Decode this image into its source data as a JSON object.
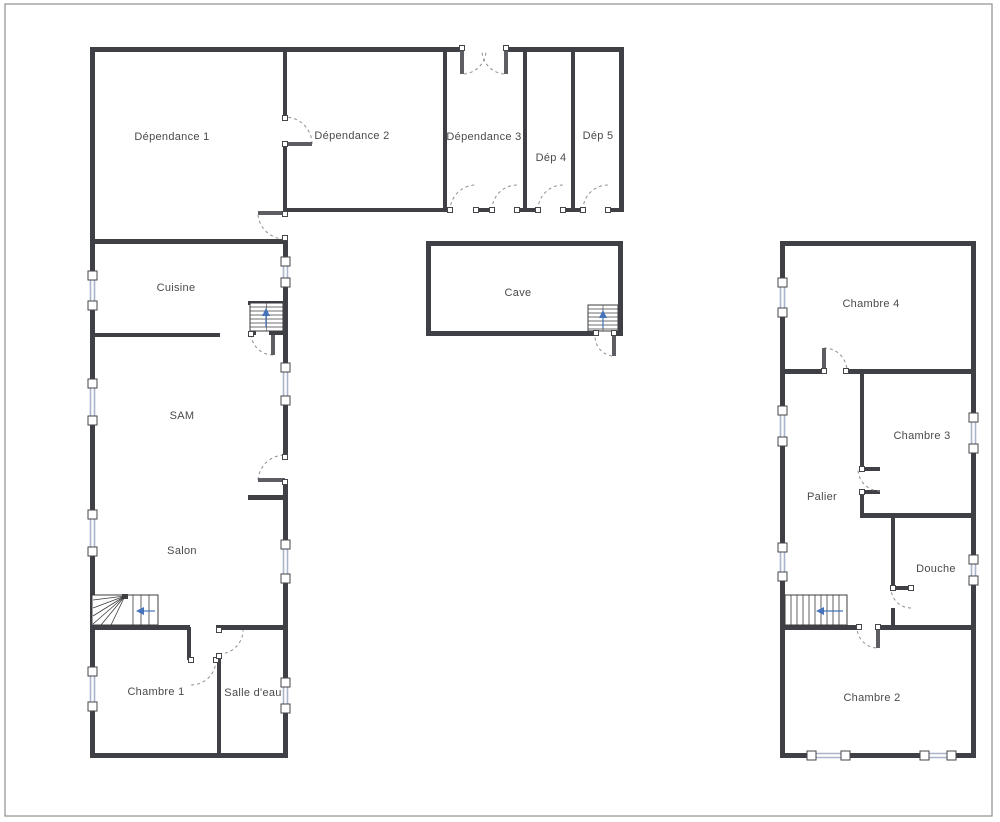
{
  "title": "Plan d'étage",
  "colors": {
    "background": "#ffffff",
    "page_border": "#8f8f8f",
    "wall": "#3f4045",
    "door_leaf": "#5d5e63",
    "door_arc": "#8f8f8f",
    "hinge_fill": "#ffffff",
    "hinge_stroke": "#45464a",
    "window_glass": "#a9b4cd",
    "window_frame": "#45464a",
    "stair_line": "#3c3c3f",
    "stair_arrow": "#4573b9",
    "label": "#4a4a4a"
  },
  "canvas": {
    "width": 1000,
    "height": 822,
    "page_border": [
      5,
      4,
      987,
      812
    ]
  },
  "rooms": [
    {
      "id": "dependance-1",
      "label": "Dépendance 1",
      "x": 172,
      "y": 137
    },
    {
      "id": "dependance-2",
      "label": "Dépendance 2",
      "x": 352,
      "y": 136
    },
    {
      "id": "dependance-3",
      "label": "Dépendance 3",
      "x": 484,
      "y": 137
    },
    {
      "id": "dep-4",
      "label": "Dép 4",
      "x": 551,
      "y": 158
    },
    {
      "id": "dep-5",
      "label": "Dép 5",
      "x": 598,
      "y": 136
    },
    {
      "id": "cuisine",
      "label": "Cuisine",
      "x": 176,
      "y": 288
    },
    {
      "id": "cave",
      "label": "Cave",
      "x": 518,
      "y": 293
    },
    {
      "id": "sam",
      "label": "SAM",
      "x": 182,
      "y": 416
    },
    {
      "id": "salon",
      "label": "Salon",
      "x": 182,
      "y": 551
    },
    {
      "id": "chambre-1",
      "label": "Chambre 1",
      "x": 156,
      "y": 692
    },
    {
      "id": "salle-d-eau",
      "label": "Salle d'eau",
      "x": 253,
      "y": 693
    },
    {
      "id": "chambre-4",
      "label": "Chambre 4",
      "x": 871,
      "y": 304
    },
    {
      "id": "chambre-3",
      "label": "Chambre 3",
      "x": 922,
      "y": 436
    },
    {
      "id": "palier",
      "label": "Palier",
      "x": 822,
      "y": 497
    },
    {
      "id": "douche",
      "label": "Douche",
      "x": 936,
      "y": 569
    },
    {
      "id": "chambre-2",
      "label": "Chambre 2",
      "x": 872,
      "y": 698
    }
  ],
  "walls": [
    [
      90,
      47,
      370,
      5
    ],
    [
      508,
      47,
      116,
      5
    ],
    [
      90,
      47,
      5,
      224
    ],
    [
      90,
      310,
      5,
      69
    ],
    [
      90,
      425,
      5,
      85
    ],
    [
      90,
      556,
      5,
      111
    ],
    [
      90,
      711,
      5,
      47
    ],
    [
      90,
      753,
      198,
      5
    ],
    [
      283,
      47,
      4,
      71
    ],
    [
      283,
      144,
      4,
      70
    ],
    [
      90,
      239,
      198,
      5
    ],
    [
      283,
      244,
      5,
      13
    ],
    [
      283,
      287,
      5,
      76
    ],
    [
      283,
      405,
      5,
      52
    ],
    [
      283,
      482,
      5,
      58
    ],
    [
      283,
      583,
      5,
      95
    ],
    [
      283,
      713,
      5,
      45
    ],
    [
      90,
      333,
      130,
      4
    ],
    [
      248,
      495,
      37,
      5
    ],
    [
      443,
      47,
      4,
      165
    ],
    [
      523,
      47,
      4,
      165
    ],
    [
      571,
      47,
      4,
      165
    ],
    [
      619,
      47,
      5,
      165
    ],
    [
      285,
      208,
      165,
      4
    ],
    [
      476,
      208,
      16,
      4
    ],
    [
      517,
      208,
      21,
      4
    ],
    [
      563,
      208,
      20,
      4
    ],
    [
      608,
      208,
      16,
      4
    ],
    [
      90,
      625,
      100,
      5
    ],
    [
      216,
      625,
      67,
      5
    ],
    [
      187,
      627,
      4,
      33
    ],
    [
      217,
      656,
      4,
      99
    ],
    [
      426,
      241,
      197,
      5
    ],
    [
      426,
      241,
      5,
      95
    ],
    [
      618,
      241,
      5,
      95
    ],
    [
      426,
      331,
      170,
      5
    ],
    [
      614,
      331,
      9,
      5
    ],
    [
      248,
      301,
      37,
      4
    ],
    [
      248,
      331,
      8,
      4
    ],
    [
      269,
      331,
      14,
      4
    ],
    [
      780,
      241,
      196,
      5
    ],
    [
      780,
      241,
      5,
      37
    ],
    [
      780,
      317,
      5,
      89
    ],
    [
      780,
      446,
      5,
      97
    ],
    [
      780,
      581,
      5,
      177
    ],
    [
      971,
      241,
      5,
      172
    ],
    [
      971,
      453,
      5,
      102
    ],
    [
      971,
      585,
      5,
      173
    ],
    [
      780,
      753,
      27,
      5
    ],
    [
      850,
      753,
      70,
      5
    ],
    [
      956,
      753,
      20,
      5
    ],
    [
      780,
      369,
      44,
      5
    ],
    [
      846,
      369,
      130,
      5
    ],
    [
      860,
      369,
      4,
      100
    ],
    [
      860,
      492,
      4,
      25
    ],
    [
      860,
      467,
      20,
      4
    ],
    [
      860,
      490,
      20,
      4
    ],
    [
      860,
      513,
      116,
      5
    ],
    [
      891,
      513,
      4,
      77
    ],
    [
      891,
      586,
      20,
      4
    ],
    [
      891,
      608,
      4,
      19
    ],
    [
      780,
      625,
      79,
      5
    ],
    [
      878,
      625,
      98,
      5
    ]
  ],
  "doors": [
    {
      "name": "porte-dependance1-dependance2",
      "arc": [
        312,
        144,
        27,
        0,
        285,
        117
      ],
      "leaf": [
        285,
        142,
        27,
        4
      ],
      "dots": [
        [
          285,
          118
        ],
        [
          285,
          144
        ]
      ]
    },
    {
      "name": "porte-double-dependance3-gauche",
      "arc": [
        464,
        74,
        24,
        0,
        486,
        50
      ],
      "leaf": [
        460,
        50,
        4,
        24
      ],
      "dots": [
        [
          462,
          48
        ]
      ]
    },
    {
      "name": "porte-double-dependance3-droite",
      "arc": [
        504,
        74,
        24,
        1,
        482,
        50
      ],
      "leaf": [
        504,
        50,
        4,
        24
      ],
      "dots": [
        [
          506,
          48
        ]
      ]
    },
    {
      "name": "porte-dependance3-sud-1",
      "arc": [
        450,
        211,
        26,
        1,
        476,
        185
      ],
      "dots": [
        [
          450,
          210
        ],
        [
          476,
          210
        ]
      ]
    },
    {
      "name": "porte-dependance3-sud-2",
      "arc": [
        492,
        210,
        25,
        1,
        517,
        185
      ],
      "dots": [
        [
          492,
          210
        ],
        [
          517,
          210
        ]
      ]
    },
    {
      "name": "porte-dep4-sud",
      "arc": [
        538,
        210,
        25,
        1,
        563,
        185
      ],
      "dots": [
        [
          538,
          210
        ],
        [
          563,
          210
        ]
      ]
    },
    {
      "name": "porte-dep5-sud",
      "arc": [
        583,
        210,
        25,
        1,
        608,
        185
      ],
      "dots": [
        [
          583,
          210
        ],
        [
          608,
          210
        ]
      ]
    },
    {
      "name": "porte-couloir-dependance1",
      "arc": [
        258,
        215,
        27,
        0,
        283,
        239
      ],
      "leaf": [
        258,
        211,
        27,
        4
      ],
      "dots": [
        [
          285,
          214
        ],
        [
          285,
          238
        ]
      ]
    },
    {
      "name": "porte-escalier-cuisine",
      "arc": [
        273,
        355,
        22,
        1,
        251,
        333
      ],
      "leaf": [
        271,
        335,
        4,
        20
      ],
      "dots": [
        [
          251,
          334
        ]
      ]
    },
    {
      "name": "porte-sam-exterieur",
      "arc": [
        258,
        480,
        27,
        1,
        285,
        455
      ],
      "leaf": [
        258,
        478,
        27,
        4
      ],
      "dots": [
        [
          285,
          457
        ],
        [
          285,
          482
        ]
      ]
    },
    {
      "name": "porte-chambre-1",
      "arc": [
        216,
        660,
        25,
        1,
        191,
        685
      ],
      "dots": [
        [
          191,
          660
        ],
        [
          216,
          660
        ]
      ]
    },
    {
      "name": "porte-salle-d-eau",
      "arc": [
        219,
        654,
        24,
        0,
        243,
        630
      ],
      "dots": [
        [
          219,
          630
        ],
        [
          219,
          656
        ]
      ]
    },
    {
      "name": "porte-cave",
      "arc": [
        612,
        356,
        20,
        1,
        595,
        336
      ],
      "leaf": [
        612,
        336,
        4,
        20
      ],
      "dots": [
        [
          596,
          333
        ],
        [
          614,
          333
        ]
      ]
    },
    {
      "name": "porte-chambre-4",
      "arc": [
        824,
        348,
        23,
        1,
        847,
        371
      ],
      "leaf": [
        822,
        348,
        4,
        23
      ],
      "dots": [
        [
          824,
          371
        ],
        [
          846,
          371
        ]
      ]
    },
    {
      "name": "porte-chambre-3",
      "arc": [
        880,
        491,
        22,
        1,
        858,
        469
      ],
      "dots": [
        [
          862,
          469
        ],
        [
          862,
          492
        ]
      ]
    },
    {
      "name": "porte-douche",
      "arc": [
        911,
        608,
        20,
        1,
        891,
        588
      ],
      "dots": [
        [
          893,
          588
        ],
        [
          911,
          588
        ]
      ]
    },
    {
      "name": "porte-chambre-2",
      "arc": [
        876,
        648,
        21,
        1,
        857,
        627
      ],
      "leaf": [
        876,
        627,
        4,
        21
      ],
      "dots": [
        [
          859,
          627
        ],
        [
          878,
          627
        ]
      ]
    }
  ],
  "windows": [
    {
      "o": "v",
      "x": 92.5,
      "a": 271,
      "b": 310
    },
    {
      "o": "v",
      "x": 92.5,
      "a": 379,
      "b": 425
    },
    {
      "o": "v",
      "x": 92.5,
      "a": 510,
      "b": 556
    },
    {
      "o": "v",
      "x": 92.5,
      "a": 667,
      "b": 711
    },
    {
      "o": "v",
      "x": 285.5,
      "a": 257,
      "b": 287
    },
    {
      "o": "v",
      "x": 285.5,
      "a": 363,
      "b": 405
    },
    {
      "o": "v",
      "x": 285.5,
      "a": 540,
      "b": 583
    },
    {
      "o": "v",
      "x": 285.5,
      "a": 678,
      "b": 713
    },
    {
      "o": "v",
      "x": 782.5,
      "a": 278,
      "b": 317
    },
    {
      "o": "v",
      "x": 782.5,
      "a": 406,
      "b": 446
    },
    {
      "o": "v",
      "x": 782.5,
      "a": 543,
      "b": 581
    },
    {
      "o": "v",
      "x": 973.5,
      "a": 413,
      "b": 453
    },
    {
      "o": "v",
      "x": 973.5,
      "a": 555,
      "b": 585
    },
    {
      "o": "h",
      "y": 755.5,
      "a": 807,
      "b": 850
    },
    {
      "o": "h",
      "y": 755.5,
      "a": 920,
      "b": 956
    }
  ],
  "stairs": [
    {
      "name": "escalier-cuisine",
      "box": [
        250,
        303,
        33,
        28
      ],
      "treads_y": [
        307,
        311,
        315,
        319,
        323,
        327
      ],
      "centerline": true,
      "arrow": {
        "tip": [
          266,
          308
        ],
        "tail": [
          266,
          327
        ]
      }
    },
    {
      "name": "escalier-cave",
      "box": [
        588,
        305,
        30,
        26
      ],
      "treads_y": [
        309,
        313,
        317,
        321,
        325,
        329
      ],
      "centerline": true,
      "arrow": {
        "tip": [
          603,
          310
        ],
        "tail": [
          603,
          328
        ]
      }
    },
    {
      "name": "escalier-salon",
      "box": [
        92,
        595,
        66,
        30
      ],
      "tread_xs": [
        133,
        141,
        149
      ],
      "fan": {
        "node": [
          125,
          596
        ],
        "targets": [
          [
            93,
            600
          ],
          [
            93,
            608
          ],
          [
            93,
            616
          ],
          [
            93,
            624
          ],
          [
            101,
            625
          ],
          [
            111,
            625
          ]
        ]
      },
      "arrow": {
        "tip": [
          136,
          611
        ],
        "tail": [
          155,
          611
        ]
      }
    },
    {
      "name": "escalier-palier",
      "box": [
        785,
        595,
        62,
        30
      ],
      "tread_xs": [
        791,
        797,
        803,
        809,
        815,
        821,
        827,
        833,
        839
      ],
      "arrow": {
        "tip": [
          816,
          611
        ],
        "tail": [
          843,
          611
        ]
      }
    }
  ]
}
